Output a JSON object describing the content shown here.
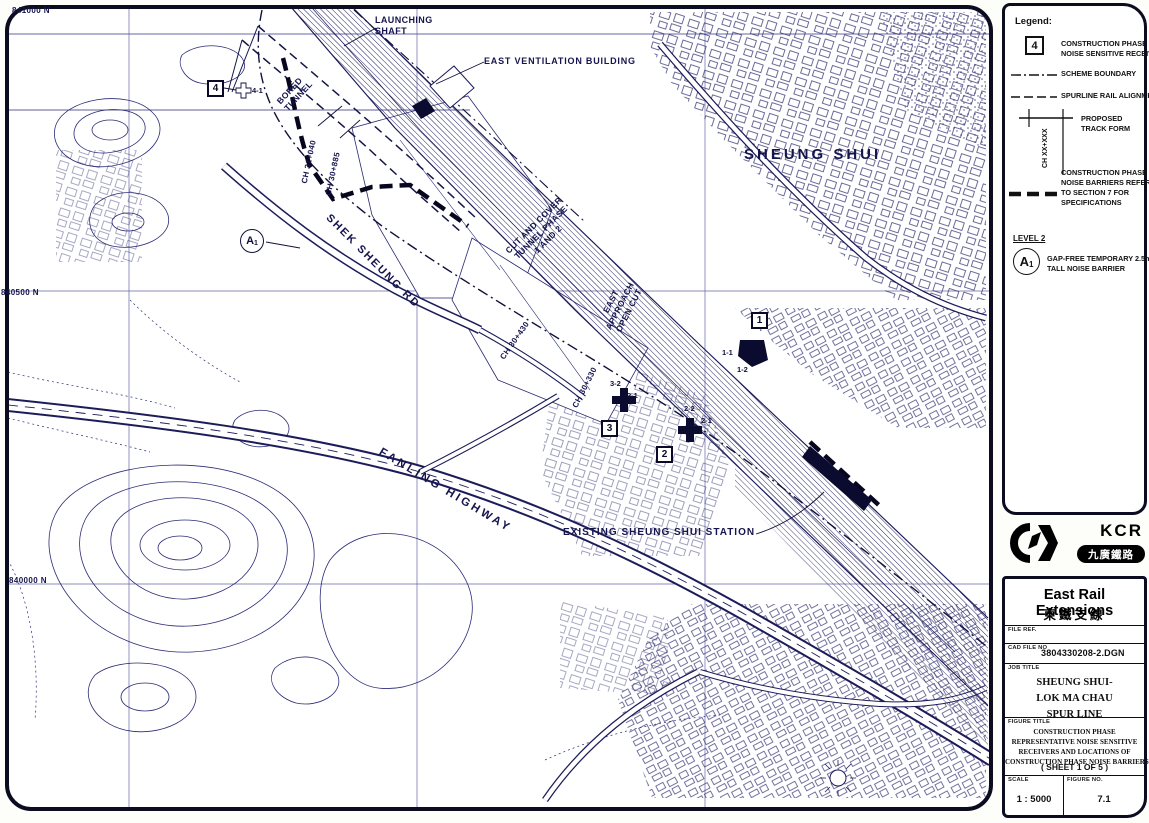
{
  "map": {
    "grid": {
      "n841000": "841000 N",
      "n840500": "840500 N",
      "n840000": "840000 N"
    },
    "labels": {
      "launching_shaft": "LAUNCHING\nSHAFT",
      "east_ventilation": "EAST VENTILATION BUILDING",
      "bored_tunnel": "BORED\nTUNNEL",
      "shek_sheung_rd": "SHEK SHEUNG RD",
      "sheung_shui": "SHEUNG SHUI",
      "cut_and_cover": "CUT AND COVER\nTUNNEL PHASE\n1 AND 2",
      "east_approach": "EAST\nAPPROACH\nOPEN CUT",
      "fanling_highway": "FANLING HIGHWAY",
      "existing_station": "EXISTING SHEUNG SHUI STATION",
      "ch_31_040": "CH 31+040",
      "ch_30_885": "CH 30+885",
      "ch_30_430": "CH 30+430",
      "ch_30_330": "CH 30+330"
    },
    "receivers": {
      "r4": "4",
      "r3": "3",
      "r2": "2",
      "r1": "1",
      "u4_1": "4-1",
      "u3_2": "3-2",
      "u3_1": "3-1",
      "u2_2": "2-2",
      "u2_1": "2-1",
      "u1_1": "1-1",
      "u1_2": "1-2"
    },
    "a1": {
      "main": "A",
      "sub": "1"
    }
  },
  "legend": {
    "title": "Legend:",
    "receiver_box": "4",
    "receiver_text": "CONSTRUCTION PHASE\nNOISE SENSITIVE RECEIVER",
    "scheme_boundary": "SCHEME BOUNDARY",
    "spurline": "SPURLINE RAIL ALIGNMENT",
    "track_form": "PROPOSED\nTRACK FORM",
    "track_ch": "CH XX+XXX",
    "barrier_text": "CONSTRUCTION PHASE\nNOISE BARRIERS REFER\nTO SECTION 7 FOR\nSPECIFICATIONS",
    "level2": "LEVEL 2",
    "a_main": "A",
    "a_sub": "1",
    "a1_text": "GAP-FREE TEMPORARY 2.5m\nTALL NOISE BARRIER"
  },
  "logo": {
    "kcr": "KCR",
    "chinese": "九廣鐵路"
  },
  "title_block": {
    "title_en": "East Rail Extensions",
    "title_zh": "東鐵支線",
    "file_ref_label": "FILE REF.",
    "cad_label": "CAD FILE NO",
    "cad_value": "3804330208-2.DGN",
    "job_label": "JOB TITLE",
    "job_title": "SHEUNG SHUI-\nLOK MA CHAU\nSPUR LINE",
    "figure_label": "FIGURE TITLE",
    "figure_title": "CONSTRUCTION PHASE\nREPRESENTATIVE NOISE SENSITIVE\nRECEIVERS AND LOCATIONS OF\nCONSTRUCTION PHASE NOISE BARRIERS",
    "sheet": "( SHEET 1 OF 5 )",
    "scale_label": "SCALE",
    "scale_value": "1 : 5000",
    "fig_no_label": "FIGURE NO.",
    "fig_no_value": "7.1"
  },
  "colors": {
    "linework": "#23235f",
    "bold_line": "#06061e",
    "paper": "#ffffff"
  }
}
